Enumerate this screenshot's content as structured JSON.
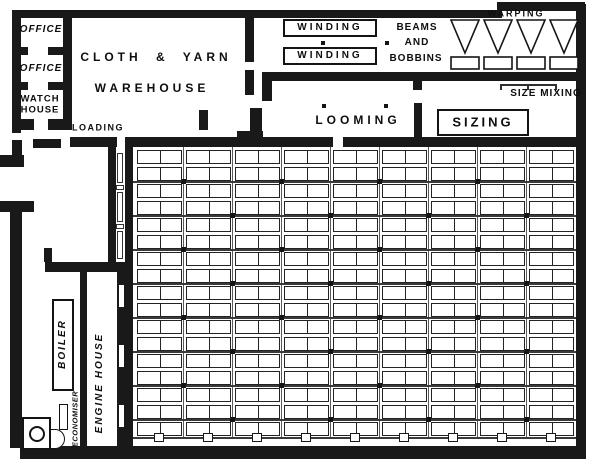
{
  "title": "Weaving mill ground plan",
  "colors": {
    "wall": "#191919",
    "paper": "#ffffff"
  },
  "rooms": {
    "office_top": {
      "label": "OFFICE"
    },
    "office_mid": {
      "label": "OFFICE"
    },
    "watch_house": {
      "line1": "WATCH",
      "line2": "HOUSE"
    },
    "warehouse": {
      "line1": "CLOTH & YARN",
      "line2": "WAREHOUSE"
    },
    "loading": {
      "label": "LOADING"
    },
    "winding_a": {
      "label": "WINDING"
    },
    "winding_b": {
      "label": "WINDING"
    },
    "beams_bobbins": {
      "line1": "BEAMS",
      "line2": "AND",
      "line3": "BOBBINS"
    },
    "warping": {
      "label": "WARPING",
      "machines": 4
    },
    "size_mixing": {
      "label": "SIZE MIXING"
    },
    "looming": {
      "label": "LOOMING"
    },
    "sizing": {
      "label": "SIZING"
    },
    "boiler": {
      "label": "BOILER"
    },
    "economiser": {
      "label": "ECONOMISER"
    },
    "engine_house": {
      "label": "ENGINE HOUSE"
    }
  },
  "weaving_shed": {
    "loom_stacks": 9,
    "loom_rows": 17,
    "shaft_lines": 8,
    "stack_x0": 4,
    "stack_pitch": 49,
    "loom_width": 45,
    "row_y0": 3,
    "row_pitch": 17,
    "loom_height": 14,
    "inner_right": 443,
    "inner_bottom": 290
  }
}
